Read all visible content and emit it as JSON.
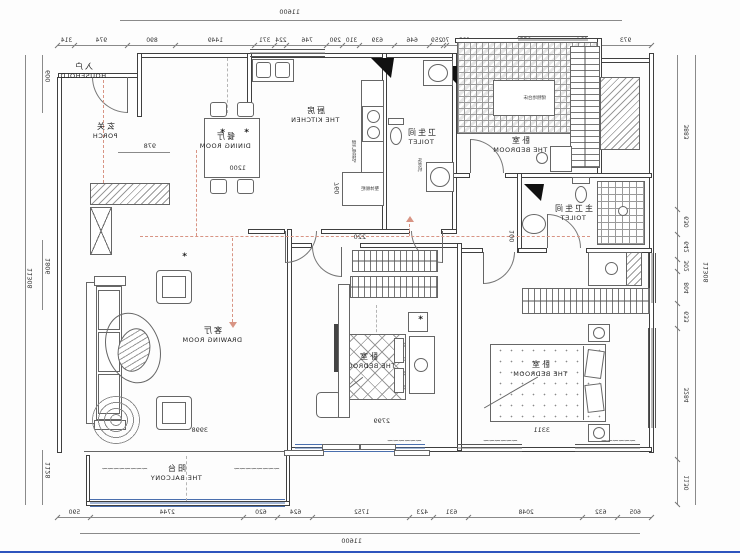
{
  "palette": {
    "line": "#3f3f3f",
    "thin": "#7a7a7a",
    "pattern": "#9a9a9a",
    "guide_salmon": "#d89484",
    "guide_gray": "#b5b5b5",
    "window_blue": "#4a6fae",
    "frame_blue": "#2e54bd"
  },
  "totals": {
    "width_top": "11600",
    "width_bottom": "11600",
    "height_left": "11308",
    "height_right": "11308"
  },
  "chains": {
    "top": [
      973,
      624,
      1551,
      623,
      70,
      259,
      646,
      639,
      310,
      290,
      746,
      224,
      371,
      1449,
      890,
      974,
      314
    ],
    "bottom": [
      605,
      632,
      2048,
      631,
      423,
      1752,
      624,
      620,
      2744,
      590
    ],
    "side": [
      3883,
      630,
      642,
      302,
      804,
      633,
      3284,
      1130
    ]
  },
  "side_dims": {
    "porch_top": "600",
    "living": "1806",
    "balcony": "1128"
  },
  "dims": {
    "dining": "1200",
    "porch": "978",
    "kitchen": "760",
    "hall": "220",
    "bath": "100",
    "bed_mid": "2799",
    "bed_left": "3311",
    "living": "3998"
  },
  "rooms": {
    "household": {
      "zh": "入户",
      "en": "HOUSEHOLD"
    },
    "porch": {
      "zh": "玄关",
      "en": "PORCH"
    },
    "kitchen": {
      "zh": "厨房",
      "en": "THE KITCHEN"
    },
    "dining": {
      "zh": "餐厅",
      "en": "DINING ROOM"
    },
    "toilet": {
      "zh": "卫生间",
      "en": "TOILET"
    },
    "master_toilet": {
      "zh": "主卫生间",
      "en": "TOILET"
    },
    "bedroom_top": {
      "zh": "卧室",
      "en": "THE BEDROOM"
    },
    "bedroom_mid": {
      "zh": "卧室",
      "en": "THE BEDROOM"
    },
    "bedroom_left": {
      "zh": "卧室",
      "en": "THE BEDROOM"
    },
    "drawing_room": {
      "zh": "客厅",
      "en": "DRAWING ROOM"
    },
    "balcony": {
      "zh": "阳台",
      "en": "THE BALCONY"
    }
  },
  "annotations": {
    "washer": "洗衣机",
    "boiler": "燃气壁挂炉",
    "cabinet": "整体橱柜",
    "platform": "储物地台床"
  }
}
